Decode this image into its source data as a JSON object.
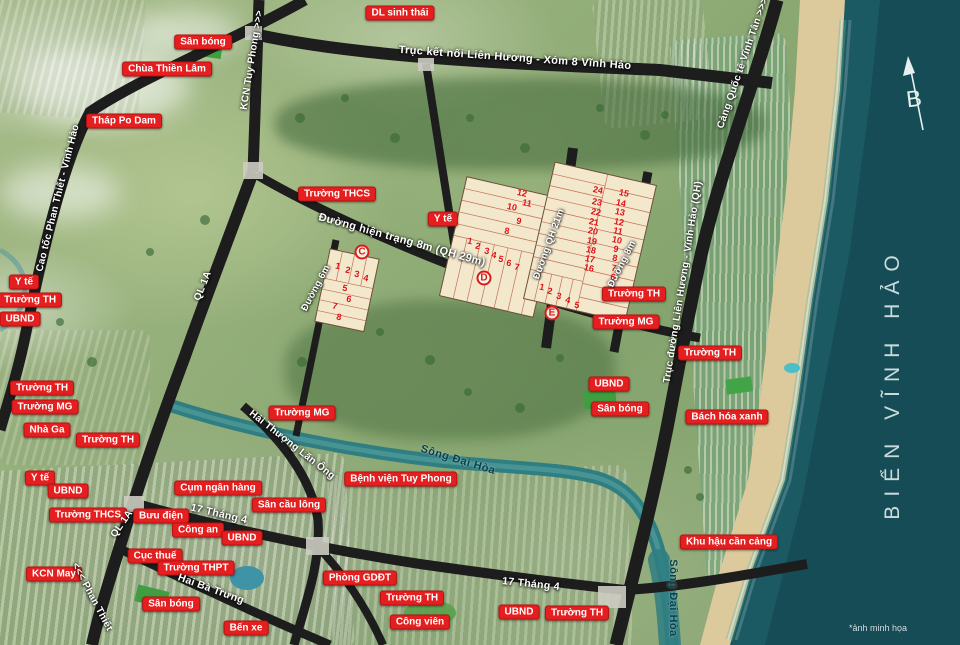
{
  "map": {
    "sea_label": "BIỂN VĨNH HẢO",
    "watermark": "*ảnh minh họa",
    "compass_letter": "B",
    "colors": {
      "sea": "#1c5a63",
      "sand": "#dcc99c",
      "road": "#1d1d1d",
      "river": "#2f7e82",
      "lot_fill": "#f3e8cc",
      "label_red": "#e51f1f"
    },
    "poi_labels": [
      {
        "text": "Sân bóng",
        "x": 203,
        "y": 42
      },
      {
        "text": "Chùa Thiền Lâm",
        "x": 167,
        "y": 69
      },
      {
        "text": "Tháp Po Dam",
        "x": 124,
        "y": 121
      },
      {
        "text": "DL sinh thái",
        "x": 400,
        "y": 13
      },
      {
        "text": "Trường THCS",
        "x": 337,
        "y": 194
      },
      {
        "text": "Y tế",
        "x": 443,
        "y": 219
      },
      {
        "text": "Y tế",
        "x": 24,
        "y": 282
      },
      {
        "text": "Trường TH",
        "x": 30,
        "y": 300
      },
      {
        "text": "UBND",
        "x": 20,
        "y": 319
      },
      {
        "text": "Trường TH",
        "x": 42,
        "y": 388
      },
      {
        "text": "Trường MG",
        "x": 45,
        "y": 407
      },
      {
        "text": "Nhà Ga",
        "x": 47,
        "y": 430
      },
      {
        "text": "Trường TH",
        "x": 108,
        "y": 440
      },
      {
        "text": "Y tế",
        "x": 40,
        "y": 478
      },
      {
        "text": "UBND",
        "x": 68,
        "y": 491
      },
      {
        "text": "Trường THCS",
        "x": 88,
        "y": 515
      },
      {
        "text": "Bưu điện",
        "x": 161,
        "y": 516
      },
      {
        "text": "Cụm ngân hàng",
        "x": 218,
        "y": 488
      },
      {
        "text": "Công an",
        "x": 198,
        "y": 530
      },
      {
        "text": "UBND",
        "x": 242,
        "y": 538
      },
      {
        "text": "Cục thuế",
        "x": 155,
        "y": 556
      },
      {
        "text": "Trường THPT",
        "x": 196,
        "y": 568
      },
      {
        "text": "KCN May",
        "x": 54,
        "y": 574
      },
      {
        "text": "Sân bóng",
        "x": 171,
        "y": 604
      },
      {
        "text": "Bến xe",
        "x": 246,
        "y": 628
      },
      {
        "text": "Trường MG",
        "x": 302,
        "y": 413
      },
      {
        "text": "Bệnh viện Tuy Phong",
        "x": 401,
        "y": 479
      },
      {
        "text": "Sân cầu lông",
        "x": 289,
        "y": 505
      },
      {
        "text": "Phòng GDĐT",
        "x": 360,
        "y": 578
      },
      {
        "text": "Trường TH",
        "x": 412,
        "y": 598
      },
      {
        "text": "Công viên",
        "x": 420,
        "y": 622
      },
      {
        "text": "UBND",
        "x": 519,
        "y": 612
      },
      {
        "text": "Trường TH",
        "x": 577,
        "y": 613
      },
      {
        "text": "Khu hậu cần cảng",
        "x": 729,
        "y": 542
      },
      {
        "text": "UBND",
        "x": 609,
        "y": 384
      },
      {
        "text": "Sân bóng",
        "x": 620,
        "y": 409
      },
      {
        "text": "Bách hóa xanh",
        "x": 727,
        "y": 417
      },
      {
        "text": "Trường TH",
        "x": 710,
        "y": 353
      },
      {
        "text": "Trường TH",
        "x": 634,
        "y": 294
      },
      {
        "text": "Trường MG",
        "x": 626,
        "y": 322
      }
    ],
    "road_labels": [
      {
        "text": "KCN Tuy Phong >>>",
        "x": 252,
        "y": 60,
        "rot": -81,
        "size": 10
      },
      {
        "text": "Trục kết nối Liên Hương - Xóm 8 Vĩnh Hảo",
        "x": 515,
        "y": 58,
        "rot": 4,
        "size": 11
      },
      {
        "text": "Cảng Quốc tế Vĩnh Tân >>>",
        "x": 743,
        "y": 63,
        "rot": -71,
        "size": 10
      },
      {
        "text": "Cao tốc Phan Thiết - Vĩnh Hảo",
        "x": 58,
        "y": 198,
        "rot": -76,
        "size": 10
      },
      {
        "text": "QL 1A",
        "x": 203,
        "y": 286,
        "rot": -68,
        "size": 10
      },
      {
        "text": "QL 1A",
        "x": 122,
        "y": 524,
        "rot": -55,
        "size": 10
      },
      {
        "text": "<<< Phan Thiết",
        "x": 92,
        "y": 597,
        "rot": 62,
        "size": 10
      },
      {
        "text": "Đường hiện trạng 8m (QH 29m)",
        "x": 402,
        "y": 240,
        "rot": 15.5,
        "size": 11
      },
      {
        "text": "Đường 6m",
        "x": 316,
        "y": 288,
        "rot": -62,
        "size": 9.5
      },
      {
        "text": "Đường QH 21m",
        "x": 549,
        "y": 244,
        "rot": -70,
        "size": 9.5
      },
      {
        "text": "Đường 8m",
        "x": 622,
        "y": 264,
        "rot": -63,
        "size": 9.5
      },
      {
        "text": "Trục đường Liên Hương - Vĩnh Hảo (QH)",
        "x": 683,
        "y": 282,
        "rot": -81,
        "size": 10
      },
      {
        "text": "17 Tháng 4",
        "x": 219,
        "y": 514,
        "rot": 13,
        "size": 10.5
      },
      {
        "text": "Hai Bà Trưng",
        "x": 211,
        "y": 589,
        "rot": 20,
        "size": 10.5
      },
      {
        "text": "Hải Thượng Lãn Ông",
        "x": 292,
        "y": 445,
        "rot": 38,
        "size": 10
      },
      {
        "text": "17 Tháng 4",
        "x": 531,
        "y": 584,
        "rot": 6,
        "size": 10.5
      }
    ],
    "river_labels": [
      {
        "text": "Sông Đại Hòa",
        "x": 458,
        "y": 460,
        "rot": 17
      },
      {
        "text": "Sông Đại Hòa",
        "x": 673,
        "y": 598,
        "rot": 90
      }
    ],
    "blocks": [
      {
        "id": "C",
        "x": 362,
        "y": 252,
        "lots": [
          {
            "n": 1,
            "x": 338,
            "y": 266
          },
          {
            "n": 2,
            "x": 348,
            "y": 270
          },
          {
            "n": 3,
            "x": 357,
            "y": 274
          },
          {
            "n": 4,
            "x": 366,
            "y": 278
          },
          {
            "n": 5,
            "x": 345,
            "y": 288
          },
          {
            "n": 6,
            "x": 349,
            "y": 299
          },
          {
            "n": 7,
            "x": 335,
            "y": 306
          },
          {
            "n": 8,
            "x": 339,
            "y": 317
          }
        ]
      },
      {
        "id": "D",
        "x": 484,
        "y": 278,
        "lots": [
          {
            "n": 1,
            "x": 470,
            "y": 241
          },
          {
            "n": 2,
            "x": 478,
            "y": 246
          },
          {
            "n": 3,
            "x": 487,
            "y": 251
          },
          {
            "n": 4,
            "x": 494,
            "y": 255
          },
          {
            "n": 5,
            "x": 501,
            "y": 259
          },
          {
            "n": 6,
            "x": 509,
            "y": 263
          },
          {
            "n": 7,
            "x": 517,
            "y": 267
          },
          {
            "n": 8,
            "x": 507,
            "y": 231
          },
          {
            "n": 9,
            "x": 519,
            "y": 221
          },
          {
            "n": 10,
            "x": 512,
            "y": 207
          },
          {
            "n": 11,
            "x": 527,
            "y": 203
          },
          {
            "n": 12,
            "x": 522,
            "y": 193
          }
        ]
      },
      {
        "id": "E",
        "x": 552,
        "y": 313,
        "lots": [
          {
            "n": 1,
            "x": 542,
            "y": 287
          },
          {
            "n": 2,
            "x": 550,
            "y": 291
          },
          {
            "n": 3,
            "x": 559,
            "y": 296
          },
          {
            "n": 4,
            "x": 568,
            "y": 300
          },
          {
            "n": 5,
            "x": 577,
            "y": 305
          },
          {
            "n": 16,
            "x": 589,
            "y": 268
          },
          {
            "n": 17,
            "x": 590,
            "y": 259
          },
          {
            "n": 18,
            "x": 591,
            "y": 250
          },
          {
            "n": 19,
            "x": 592,
            "y": 241
          },
          {
            "n": 20,
            "x": 593,
            "y": 231
          },
          {
            "n": 21,
            "x": 594,
            "y": 222
          },
          {
            "n": 22,
            "x": 596,
            "y": 212
          },
          {
            "n": 23,
            "x": 597,
            "y": 202
          },
          {
            "n": 24,
            "x": 598,
            "y": 190
          },
          {
            "n": 6,
            "x": 613,
            "y": 277
          },
          {
            "n": 7,
            "x": 614,
            "y": 268
          },
          {
            "n": 8,
            "x": 615,
            "y": 258
          },
          {
            "n": 9,
            "x": 616,
            "y": 249
          },
          {
            "n": 10,
            "x": 617,
            "y": 240
          },
          {
            "n": 11,
            "x": 618,
            "y": 231
          },
          {
            "n": 12,
            "x": 619,
            "y": 222
          },
          {
            "n": 13,
            "x": 620,
            "y": 212
          },
          {
            "n": 14,
            "x": 621,
            "y": 203
          },
          {
            "n": 15,
            "x": 624,
            "y": 193
          }
        ]
      }
    ]
  }
}
